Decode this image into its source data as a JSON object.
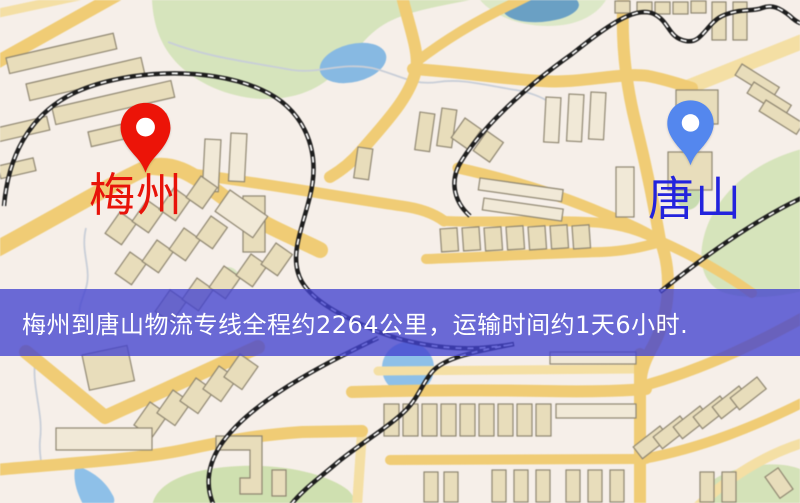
{
  "map": {
    "markers": [
      {
        "id": "meizhou",
        "label": "梅州",
        "pin_color": "#ec1408",
        "label_color": "#e8130a"
      },
      {
        "id": "tangshan",
        "label": "唐山",
        "pin_color": "#5487ee",
        "label_color": "#2323dd"
      }
    ],
    "banner": {
      "text": "梅州到唐山物流专线全程约2264公里，运输时间约1天6小时.",
      "bg_color": "#4242cf",
      "text_color": "#ffffff"
    },
    "palette": {
      "background": "#f6efe9",
      "road_main": "#f1cc71",
      "road_minor": "#f5dfa2",
      "building_fill": "#e8ddba",
      "building_light": "#f1e9d6",
      "building_outline": "#8f8670",
      "green_area": "#d5e3ba",
      "water": "#8abde8",
      "railway": "#1d1d1d"
    }
  }
}
